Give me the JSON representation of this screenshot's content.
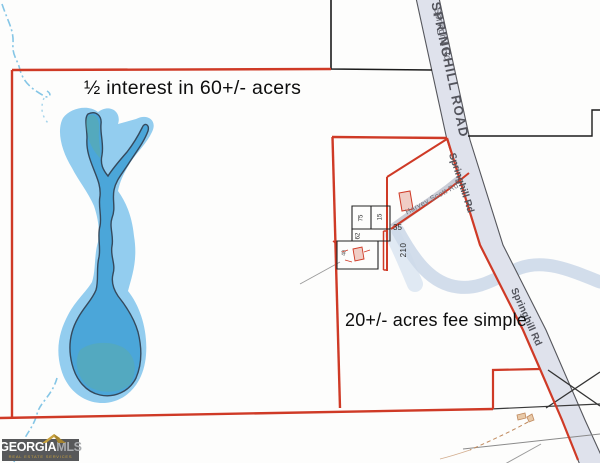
{
  "annotations": {
    "half_interest": "½ interest in 60+/- acers",
    "fee_simple": "20+/- acres fee simple"
  },
  "roads": {
    "springhill_road_main": "SPRINGHILL ROAD",
    "springhill_rd_overlap": "Springhill Rd",
    "springhill_rd_mid": "Springhill Rd",
    "springhill_rd_lower": "Springhill Rd",
    "harvey_scott_rd": "Harvey Scott Rd"
  },
  "parcel_labels": {
    "lot_35": "35",
    "lot_210": "210",
    "lot_75": "75",
    "lot_15": "15",
    "lot_62": "62",
    "lot_40": "40"
  },
  "logo": {
    "brand_primary": "GEORGIA",
    "brand_secondary": "MLS",
    "tagline": "REAL ESTATE SERVICES"
  },
  "colors": {
    "boundary_red": "#cf3a26",
    "pond_blue": "#4ba6d9",
    "pond_halo": "#93cdef",
    "pond_outline": "#35495c",
    "creek_blue": "#85c6e6",
    "stream_wash": "#cdd9e9",
    "road_fill": "#dfe2ec",
    "road_edge": "#55565c",
    "road_text": "#53545c",
    "parcel_line_black": "#1c1c1c",
    "building_pink": "#f0cdc5",
    "driveway_tan": "#c08a5e",
    "logo_bg": "#57585a",
    "logo_gold": "#c9a23f"
  }
}
